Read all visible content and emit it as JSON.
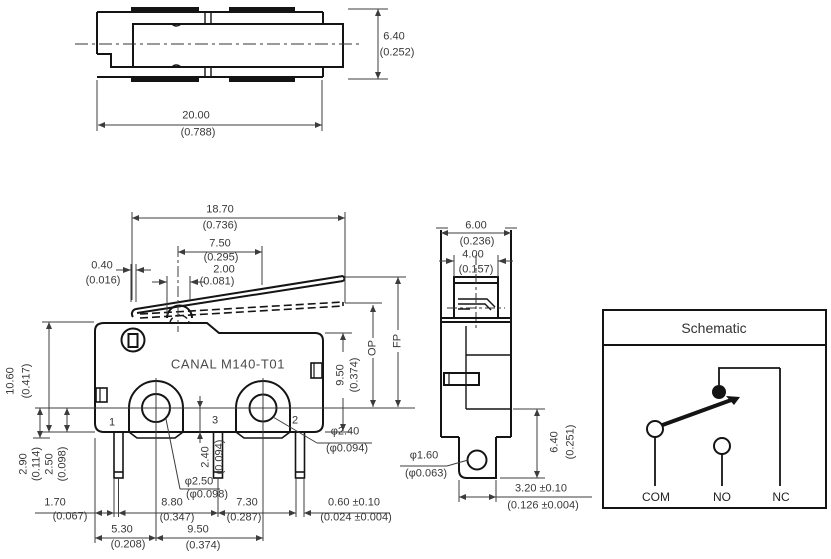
{
  "front": {
    "body_label": "CANAL M140-T01",
    "terminals": {
      "t1": "1",
      "t3": "3",
      "t2": "2"
    },
    "op_label": "OP",
    "fp_label": "FP",
    "dims": {
      "w1870": {
        "mm": "18.70",
        "in": "(0.736)"
      },
      "w750": {
        "mm": "7.50",
        "in": "(0.295)"
      },
      "w200": {
        "mm": "2.00",
        "in": "(0.081)"
      },
      "w040": {
        "mm": "0.40",
        "in": "(0.016)"
      },
      "h1060": {
        "mm": "10.60",
        "in": "(0.417)"
      },
      "h290": {
        "mm": "2.90",
        "in": "(0.114)"
      },
      "h250": {
        "mm": "2.50",
        "in": "(0.098)"
      },
      "h240": {
        "mm": "2.40",
        "in": "(0.094)"
      },
      "d250": {
        "mm": "φ2.50",
        "in": "(φ0.098)"
      },
      "d240": {
        "mm": "φ2.40",
        "in": "(φ0.094)"
      },
      "w170": {
        "mm": "1.70",
        "in": "(0.067)"
      },
      "w880": {
        "mm": "8.80",
        "in": "(0.347)"
      },
      "w730": {
        "mm": "7.30",
        "in": "(0.287)"
      },
      "w060": {
        "mm": "0.60 ±0.10",
        "in": "(0.024 ±0.004)"
      },
      "w530": {
        "mm": "5.30",
        "in": "(0.208)"
      },
      "w950": {
        "mm": "9.50",
        "in": "(0.374)"
      },
      "h950": {
        "mm": "9.50",
        "in": "(0.374)"
      }
    }
  },
  "top": {
    "dims": {
      "h640": {
        "mm": "6.40",
        "in": "(0.252)"
      },
      "w2000": {
        "mm": "20.00",
        "in": "(0.788)"
      }
    }
  },
  "side": {
    "dims": {
      "w600": {
        "mm": "6.00",
        "in": "(0.236)"
      },
      "w400": {
        "mm": "4.00",
        "in": "(0.157)"
      },
      "d160": {
        "mm": "φ1.60",
        "in": "(φ0.063)"
      },
      "h640": {
        "mm": "6.40",
        "in": "(0.251)"
      },
      "w320": {
        "mm": "3.20 ±0.10",
        "in": "(0.126 ±0.004)"
      }
    }
  },
  "schematic": {
    "title": "Schematic",
    "com": "COM",
    "no": "NO",
    "nc": "NC"
  }
}
